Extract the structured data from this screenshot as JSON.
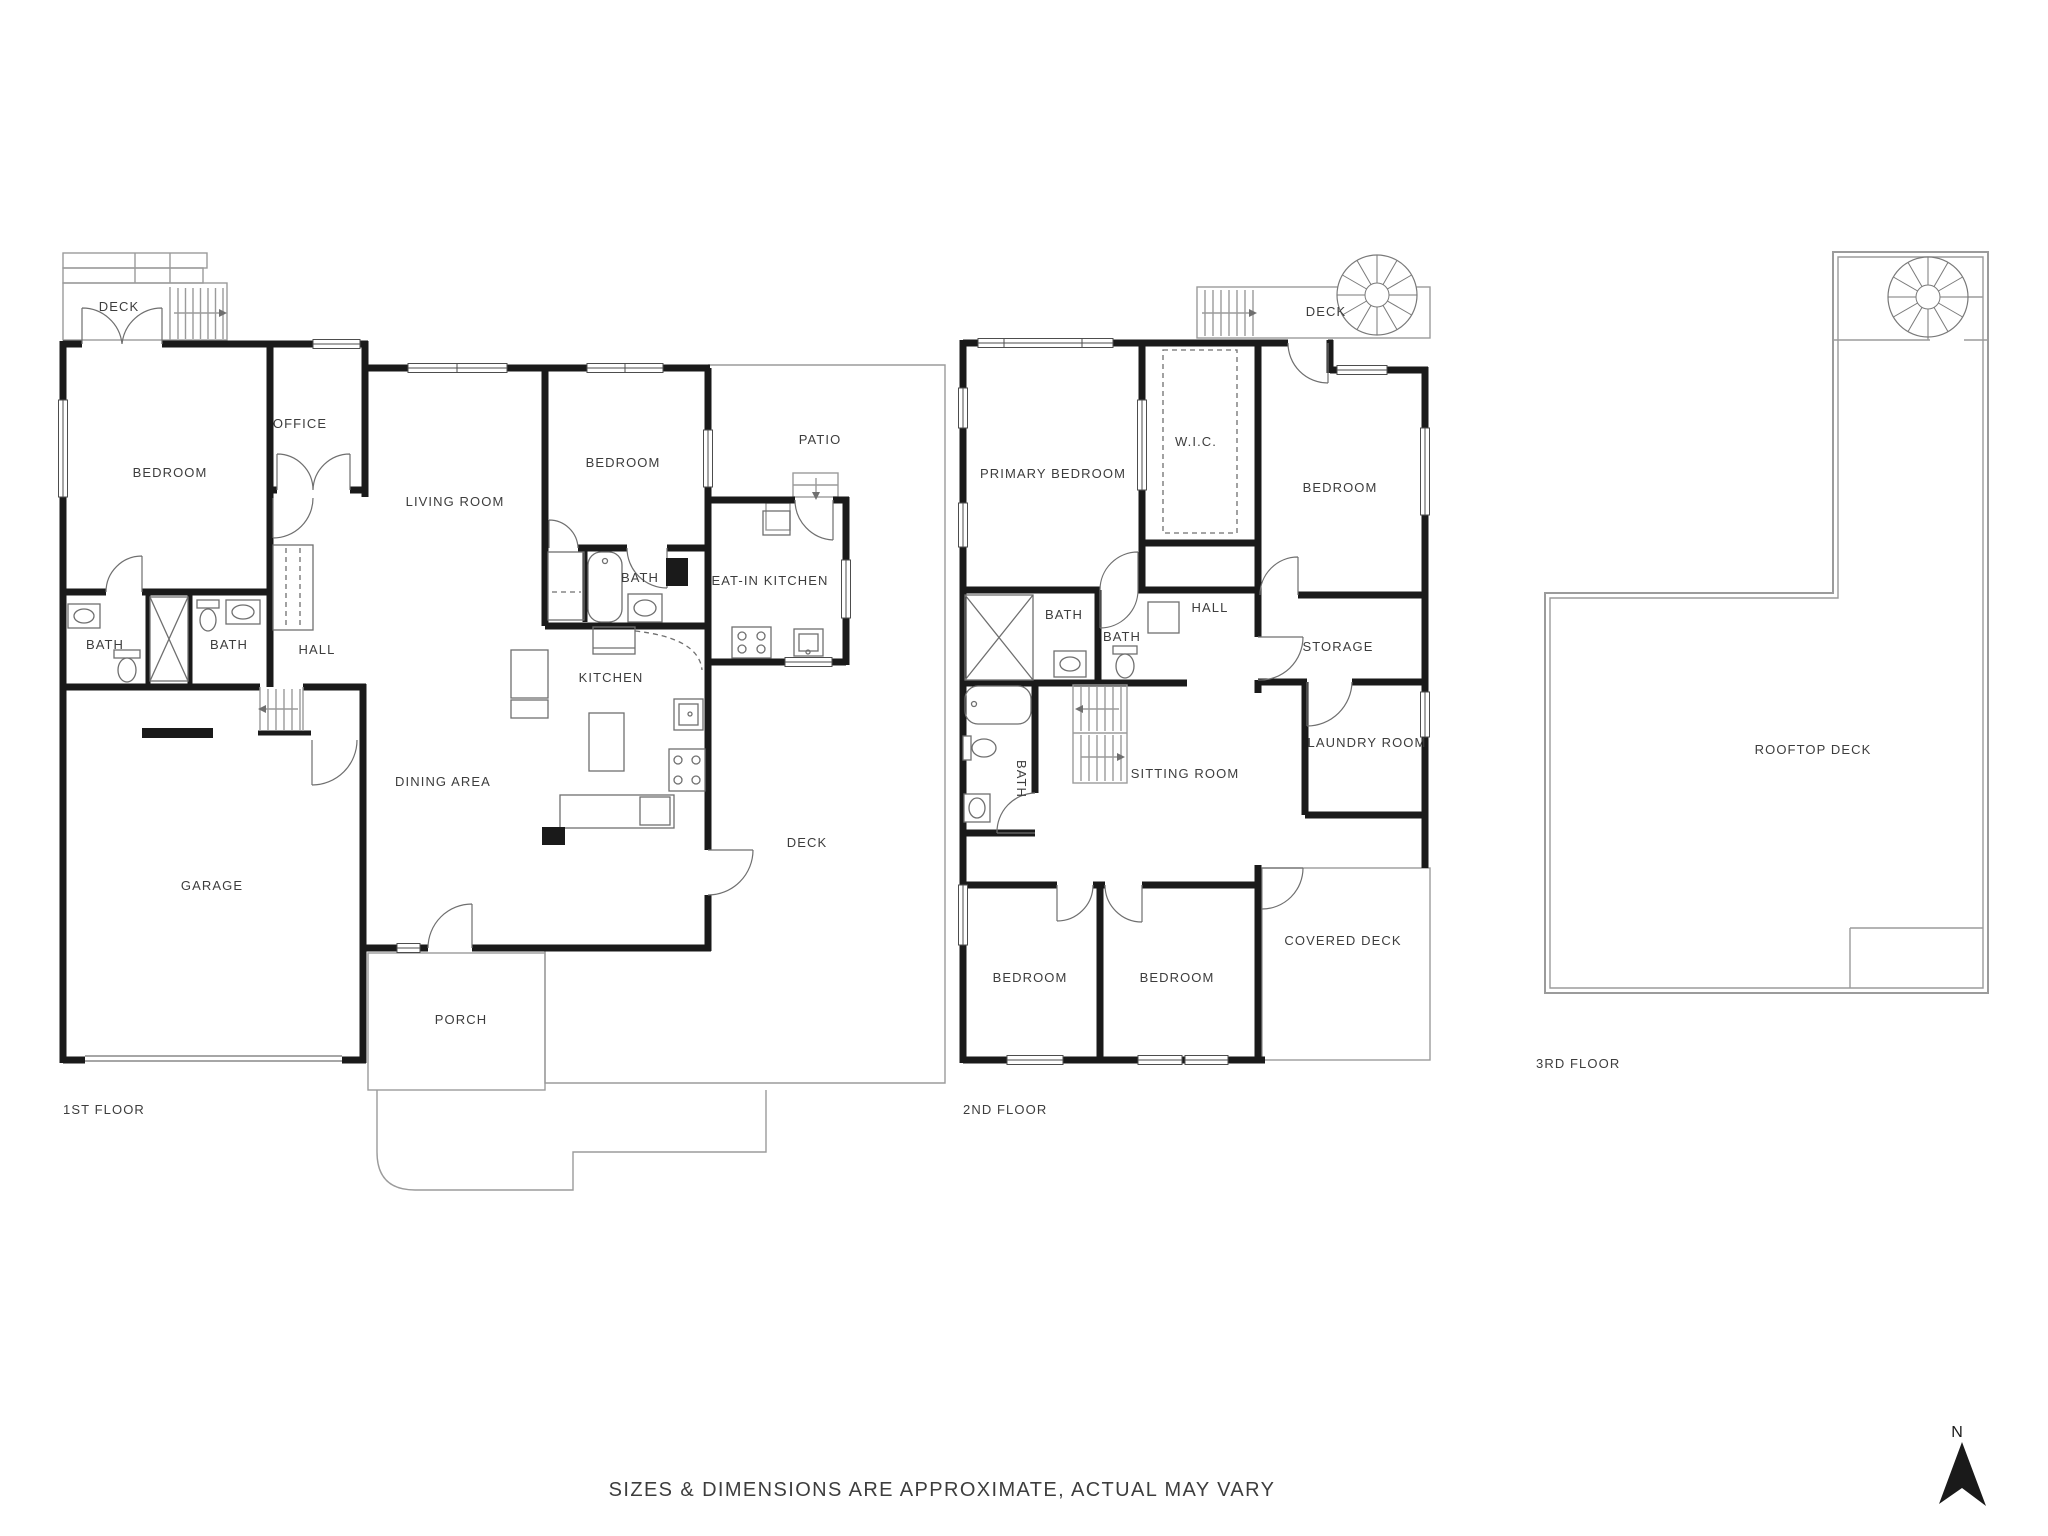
{
  "floor1": {
    "label": "1ST FLOOR",
    "rooms": {
      "deck": "DECK",
      "bedroom": "BEDROOM",
      "office": "OFFICE",
      "living_room": "LIVING ROOM",
      "bedroom2": "BEDROOM",
      "patio": "PATIO",
      "bath_middle": "BATH",
      "eat_in_kitchen": "EAT-IN KITCHEN",
      "bath1": "BATH",
      "bath2": "BATH",
      "hall": "HALL",
      "kitchen": "KITCHEN",
      "dining_area": "DINING AREA",
      "garage": "GARAGE",
      "deck_right": "DECK",
      "porch": "PORCH"
    }
  },
  "floor2": {
    "label": "2ND FLOOR",
    "rooms": {
      "deck": "DECK",
      "primary_bedroom": "PRIMARY BEDROOM",
      "wic": "W.I.C.",
      "bedroom_ne": "BEDROOM",
      "bath1": "BATH",
      "bath2": "BATH",
      "hall": "HALL",
      "storage": "STORAGE",
      "laundry_room": "LAUNDRY ROOM",
      "bath3": "BATH",
      "sitting_room": "SITTING ROOM",
      "bedroom_sw": "BEDROOM",
      "bedroom_s": "BEDROOM",
      "covered_deck": "COVERED DECK"
    }
  },
  "floor3": {
    "label": "3RD FLOOR",
    "rooms": {
      "rooftop_deck": "ROOFTOP DECK"
    }
  },
  "footer": {
    "disclaimer": "SIZES & DIMENSIONS ARE APPROXIMATE, ACTUAL MAY VARY"
  },
  "compass": {
    "north": "N"
  },
  "colors": {
    "wall": "#1a1a1a",
    "line": "#6f6f6f",
    "thin": "#9b9b9b",
    "text": "#3d3d3d",
    "bg": "#ffffff"
  }
}
